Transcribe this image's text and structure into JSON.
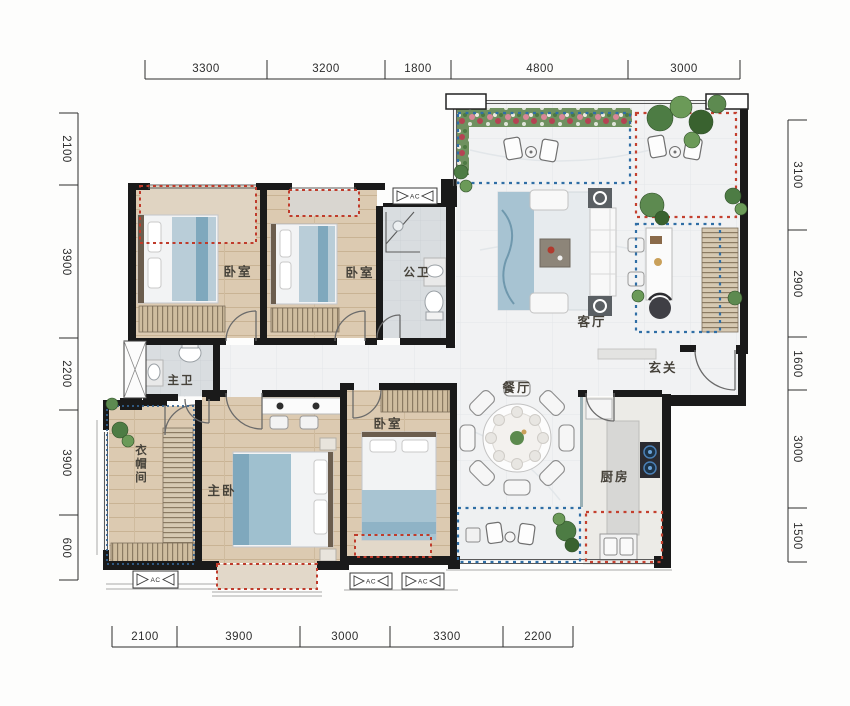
{
  "dims": {
    "top": [
      "3300",
      "3200",
      "1800",
      "4800",
      "3000"
    ],
    "bottom": [
      "2100",
      "3900",
      "3000",
      "3300",
      "2200"
    ],
    "left": [
      "2100",
      "3900",
      "2200",
      "3900",
      "600"
    ],
    "right": [
      "3100",
      "2900",
      "1600",
      "3000",
      "1500"
    ]
  },
  "rooms": {
    "bedroom_a": "卧室",
    "bedroom_b": "卧室",
    "public_bath": "公卫",
    "living_room": "客厅",
    "foyer": "玄关",
    "dining_room": "餐厅",
    "master_bath": "主卫",
    "cloakroom": "衣帽间",
    "master_bedroom": "主卧",
    "bedroom_c": "卧室",
    "kitchen": "厨房"
  },
  "markers": {
    "ac": "AC"
  },
  "colors": {
    "wall": "#1a1a1a",
    "dim_text": "#2d2d2d",
    "label_text": "#46423a",
    "bay_window_dash": "#bf3b2b",
    "zone_blue_dash": "#2f6ea5",
    "zone_red_dash": "#c4402f",
    "wood_floor": "#dccab1",
    "tile_floor": "#f1f2f3",
    "plant_green": "#4d7c44"
  }
}
